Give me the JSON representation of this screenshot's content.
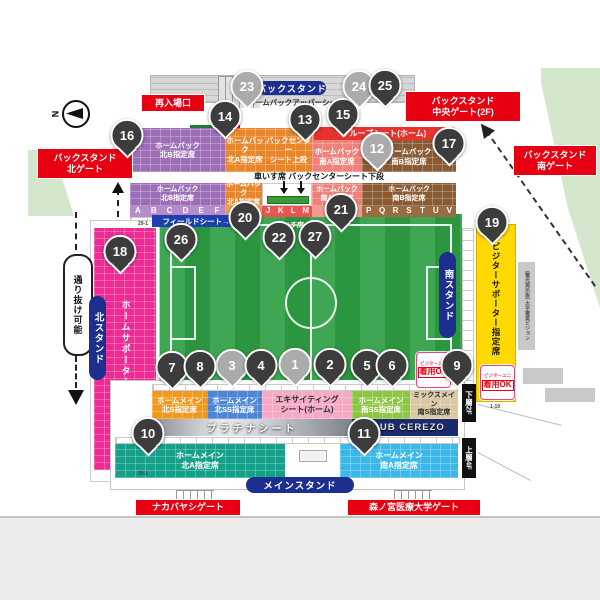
{
  "compass": {
    "label": "N"
  },
  "gates": {
    "reentry": "再入場口",
    "back_north": "バックスタンド\n北ゲート",
    "back_center": "バックスタンド\n中央ゲート(2F)",
    "back_south": "バックスタンド\n南ゲート",
    "main_north": "ナカバヤシゲート",
    "main_south": "森ノ宮医療大学ゲート"
  },
  "stands": {
    "back": "バックスタンド",
    "north": "北スタンド",
    "south": "南スタンド",
    "main": "メインスタンド"
  },
  "backstand": {
    "upper_tier_label": "ホームバックアッパーシート",
    "group_seat": "グループシート(ホーム)",
    "north_b_upper": "ホームバック\n北B指定席",
    "north_a_upper": "ホームバック\n北A指定席",
    "center_upper": "バックセンター\nシート上段",
    "south_a_upper": "ホームバック\n南A指定席",
    "south_b_upper": "ホームバック\n南B指定席",
    "wheelchair_note": "車いす席 バックセンターシート下段",
    "north_b_lower": "ホームバック\n北B指定席",
    "north_a_lower": "ホームバック\n北A指定席",
    "south_a_lower": "ホームバック\n南A指定席",
    "south_b_lower": "ホームバック\n南B指定席",
    "letters": [
      "A",
      "B",
      "C",
      "D",
      "E",
      "F",
      "G",
      "J",
      "K",
      "L",
      "M",
      "P",
      "Q",
      "R",
      "S",
      "T",
      "U",
      "V"
    ]
  },
  "field": {
    "field_seat_label": "フィールドシート→",
    "wheelchair_label": "車いす席"
  },
  "north_stand": {
    "home_supporter": "ホームサポーター席",
    "passage": "通り抜け可能",
    "row_start": "29-1",
    "row_end": "29-1"
  },
  "south_side": {
    "visitor_seat": "ビジターサポーター指定席",
    "vision": "(電光掲示板)\n太平電業ビジョン",
    "badge_line1": "ビジターユニ",
    "badge_line2": "着用OK",
    "tick": "1-19"
  },
  "main_stand": {
    "north_s": "ホームメイン\n北S指定席",
    "north_ss": "ホームメイン\n北SS指定席",
    "exciting": "エキサイティング\nシート(ホーム)",
    "south_ss": "ホームメイン\n南SS指定席",
    "mix_south_s": "ミックスメイン\n南S指定席",
    "platinum": "プラチナシート",
    "club_cerezo": "CLUB CEREZO",
    "north_a": "ホームメイン\n北A指定席",
    "south_a": "ホームメイン\n南A指定席",
    "lower_2f": "下層2F",
    "upper_4f": "上層4F"
  },
  "colors": {
    "gate_red": "#e60012",
    "stand_navy": "#1d2f8e",
    "north_b_purple": "#9d6db8",
    "north_a_orange": "#e8862c",
    "south_a_salmon": "#f08078",
    "south_b_brown": "#8a5a32",
    "home_supporter_pink": "#ee2a94",
    "visitor_yellow": "#ffd900",
    "pitch_green": "#2f9e44",
    "main_north_s": "#f3981d",
    "main_north_ss": "#4e86d4",
    "exciting_pink": "#f7a8c4",
    "main_south_ss": "#8dc63f",
    "mix_tan": "#d9c8a2",
    "main_north_a_teal": "#17a089",
    "main_south_a_cyan": "#3bb8ea",
    "club_navy": "#1b2a6b",
    "pin_dark": "#3c3c3c",
    "pin_gray": "#ababab"
  },
  "markers": [
    {
      "n": "1",
      "variant": "gray"
    },
    {
      "n": "2",
      "variant": "dark"
    },
    {
      "n": "3",
      "variant": "gray"
    },
    {
      "n": "4",
      "variant": "dark"
    },
    {
      "n": "5",
      "variant": "dark"
    },
    {
      "n": "6",
      "variant": "dark"
    },
    {
      "n": "7",
      "variant": "dark"
    },
    {
      "n": "8",
      "variant": "dark"
    },
    {
      "n": "9",
      "variant": "dark"
    },
    {
      "n": "10",
      "variant": "dark"
    },
    {
      "n": "11",
      "variant": "dark"
    },
    {
      "n": "12",
      "variant": "gray"
    },
    {
      "n": "13",
      "variant": "dark"
    },
    {
      "n": "14",
      "variant": "dark"
    },
    {
      "n": "15",
      "variant": "dark"
    },
    {
      "n": "16",
      "variant": "dark"
    },
    {
      "n": "17",
      "variant": "dark"
    },
    {
      "n": "18",
      "variant": "dark"
    },
    {
      "n": "19",
      "variant": "dark"
    },
    {
      "n": "20",
      "variant": "dark"
    },
    {
      "n": "21",
      "variant": "dark"
    },
    {
      "n": "22",
      "variant": "dark"
    },
    {
      "n": "23",
      "variant": "gray"
    },
    {
      "n": "24",
      "variant": "gray"
    },
    {
      "n": "25",
      "variant": "dark"
    },
    {
      "n": "26",
      "variant": "dark"
    },
    {
      "n": "27",
      "variant": "dark"
    }
  ]
}
